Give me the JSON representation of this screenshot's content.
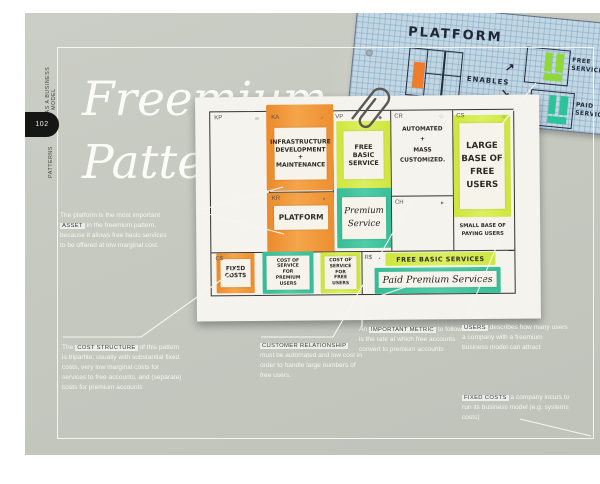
{
  "page": {
    "edge_label_top": "FREE AS A BUSINESS MODEL",
    "page_number": "102",
    "edge_label_bottom": "PATTERNS",
    "title_line1": "Freemium",
    "title_line2": "Pattern"
  },
  "sketch": {
    "platform": "PLATFORM",
    "enables": "ENABLES",
    "arrow_up": "↗",
    "arrow_down": "↘",
    "free_service": "FREE\nSERVICE",
    "paid_service": "PAID\nSERVICE"
  },
  "canvas": {
    "labels": {
      "kp": "KP",
      "ka": "KA",
      "kr": "KR",
      "vp": "VP",
      "cr": "CR",
      "ch": "CH",
      "cs": "CS",
      "cost": "C$",
      "revenue": "R$"
    },
    "icons": {
      "kp": "∞",
      "ka": "✓",
      "vp": "◆",
      "cr": "♡",
      "cs": "☺",
      "kr": "♦",
      "ch": "►",
      "cost": "✂",
      "revenue": "▪"
    },
    "notes": {
      "ka": "INFRASTRUCTURE\nDEVELOPMENT\n+\nMAINTENANCE",
      "kr": "PLATFORM",
      "vp_free": "FREE\nBASIC\nSERVICE",
      "vp_premium": "Premium\nService",
      "cr": "AUTOMATED\n+\nMASS\nCUSTOMIZED.",
      "cs": "LARGE\nBASE OF\nFREE\nUSERS",
      "cs_sub": "SMALL BASE OF\nPAYING USERS",
      "cost_fixed": "FIXED\nCOSTS",
      "cost_premium": "COST OF SERVICE\nFOR\nPREMIUM\nUSERS",
      "cost_free": "COST OF\nSERVICE FOR\nFREE\nUSERS",
      "revenue_free": "FREE BASIC SERVICES",
      "revenue_paid": "Paid Premium Services"
    }
  },
  "annotations": {
    "platform": {
      "pre": "The platform is the most important ",
      "highlight": "ASSET",
      "post": " in the freemium pattern, because it allows free basic services to be offered at low marginal cost."
    },
    "cost_structure": {
      "pre": "The ",
      "highlight": "COST STRUCTURE",
      "post": " of this pattern is tripartite: usually with substantial fixed costs, very low marginal costs for services to free accounts, and (separate) costs for premium accounts"
    },
    "customer_relationship": {
      "pre": "",
      "highlight": "CUSTOMER RELATIONSHIP",
      "post": " must be automated and low cost in order to handle large numbers of free users."
    },
    "metric": {
      "pre": "An ",
      "highlight": "IMPORTANT METRIC",
      "post": " to follow is the rate at which free accounts convert to premium accounts"
    },
    "users": {
      "pre": "",
      "highlight": "USERS",
      "post": " describes how many users a company with a freemium business model can attract"
    },
    "fixed_costs": {
      "pre": "",
      "highlight": "FIXED COSTS",
      "post": " a company incurs to run its business model (e.g. systems costs)"
    }
  },
  "colors": {
    "page_bg": "#c6c9c0",
    "sticky_orange": "#f0963a",
    "sticky_chartreuse": "#d5e94e",
    "sticky_teal": "#3fc29d",
    "graph_paper": "#c2d6e3",
    "tab_black": "#161614"
  }
}
